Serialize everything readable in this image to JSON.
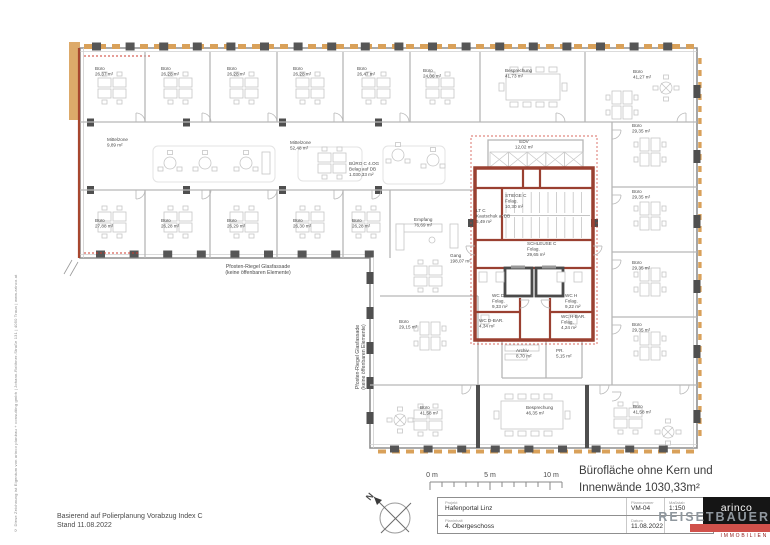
{
  "page": {
    "copyright_vertical": "© Diese Zeichnung ist Eigentum von arinco planbau + consulting gmbh | Johann-Roithner-Straße 131 | 4050 Traun | www.arinco.at",
    "revision_note_line1": "Basierend auf Polierplanung Vorabzug Index C",
    "revision_note_line2": "Stand 11.08.2022"
  },
  "area_note": {
    "line1": "Bürofläche ohne Kern und",
    "line2": "Innenwände 1030,33m²"
  },
  "titleblock": {
    "project_label": "Projekt",
    "project": "Hafenportal Linz",
    "content_label": "Planinhalt",
    "content": "4. Obergeschoss",
    "number_label": "Plannummer",
    "number": "VM-04",
    "scale_label": "Maßstab",
    "scale": "1:150",
    "date_label": "Datum",
    "date": "11.08.2022"
  },
  "logo": {
    "brand": "arinco",
    "name": "REISETBAUER",
    "tagline": "IMMOBILIEN"
  },
  "colors": {
    "facade_orange": "#d9a15a",
    "core_red": "#9a4031",
    "fire_line_red": "#cc3b2f",
    "wall_grey": "#8f8f8f",
    "logo_red": "#d0514b",
    "logo_black": "#151515"
  },
  "plan": {
    "labels": [
      {
        "lines": [
          "Büro",
          "26,37 m²"
        ],
        "x": 95,
        "y": 70
      },
      {
        "lines": [
          "Büro",
          "26,28 m²"
        ],
        "x": 161,
        "y": 70
      },
      {
        "lines": [
          "Büro",
          "26,28 m²"
        ],
        "x": 227,
        "y": 70
      },
      {
        "lines": [
          "Büro",
          "26,28 m²"
        ],
        "x": 293,
        "y": 70
      },
      {
        "lines": [
          "Büro",
          "26,47 m²"
        ],
        "x": 357,
        "y": 70
      },
      {
        "lines": [
          "Büro",
          "24,06 m²"
        ],
        "x": 423,
        "y": 72
      },
      {
        "lines": [
          "Besprechung",
          "41,73 m²"
        ],
        "x": 505,
        "y": 72
      },
      {
        "lines": [
          "Büro",
          "41,27 m²"
        ],
        "x": 633,
        "y": 73
      },
      {
        "lines": [
          "Mittelzone",
          "9,89 m²"
        ],
        "x": 107,
        "y": 141
      },
      {
        "lines": [
          "Mittelzone",
          "52,48 m²"
        ],
        "x": 290,
        "y": 144
      },
      {
        "lines": [
          "BÜRO C 4.OG",
          "Belag auf DB",
          "1.030,33 m²"
        ],
        "x": 349,
        "y": 165
      },
      {
        "lines": [
          "EDV",
          "12,02 m²"
        ],
        "x": 524,
        "y": 143,
        "align": "middle"
      },
      {
        "lines": [
          "Empfang",
          "76,69 m²"
        ],
        "x": 414,
        "y": 221
      },
      {
        "lines": [
          "Büro",
          "27,88 m²"
        ],
        "x": 95,
        "y": 222
      },
      {
        "lines": [
          "Büro",
          "26,28 m²"
        ],
        "x": 161,
        "y": 222
      },
      {
        "lines": [
          "Büro",
          "26,29 m²"
        ],
        "x": 227,
        "y": 222
      },
      {
        "lines": [
          "Büro",
          "26,30 m²"
        ],
        "x": 293,
        "y": 222
      },
      {
        "lines": [
          "Büro",
          "26,28 m²"
        ],
        "x": 352,
        "y": 222
      },
      {
        "lines": [
          "Gang",
          "198,07 m²"
        ],
        "x": 450,
        "y": 257
      },
      {
        "lines": [
          "STIEGE C",
          "Folag.",
          "10,30 m²"
        ],
        "x": 505,
        "y": 197
      },
      {
        "lines": [
          "LT C",
          "Kautschuk a. DB",
          "5,49 m²"
        ],
        "x": 476,
        "y": 212
      },
      {
        "lines": [
          "SCHLEUSE C",
          "Folag.",
          "29,65 m²"
        ],
        "x": 527,
        "y": 245
      },
      {
        "lines": [
          "WC D",
          "Folag.",
          "9,33 m²"
        ],
        "x": 492,
        "y": 297
      },
      {
        "lines": [
          "WC H",
          "Folag.",
          "9,22 m²"
        ],
        "x": 565,
        "y": 297
      },
      {
        "lines": [
          "WC D-BAR.",
          "4,34 m²"
        ],
        "x": 479,
        "y": 322
      },
      {
        "lines": [
          "WC H-BAR.",
          "Folag.",
          "4,24 m²"
        ],
        "x": 561,
        "y": 318
      },
      {
        "lines": [
          "Archiv",
          "8,70 m²"
        ],
        "x": 516,
        "y": 352
      },
      {
        "lines": [
          "PR.",
          "5,15 m²"
        ],
        "x": 556,
        "y": 352
      },
      {
        "lines": [
          "Büro",
          "29,35 m²"
        ],
        "x": 632,
        "y": 127
      },
      {
        "lines": [
          "Büro",
          "29,35 m²"
        ],
        "x": 632,
        "y": 193
      },
      {
        "lines": [
          "Büro",
          "29,35 m²"
        ],
        "x": 632,
        "y": 264
      },
      {
        "lines": [
          "Büro",
          "29,35 m²"
        ],
        "x": 632,
        "y": 326
      },
      {
        "lines": [
          "Büro",
          "41,58 m²"
        ],
        "x": 633,
        "y": 408
      },
      {
        "lines": [
          "Büro",
          "41,58 m²"
        ],
        "x": 420,
        "y": 409
      },
      {
        "lines": [
          "Besprechung",
          "46,35 m²"
        ],
        "x": 526,
        "y": 409
      },
      {
        "lines": [
          "Büro",
          "29,15 m²"
        ],
        "x": 399,
        "y": 323
      },
      {
        "lines": [
          "Pfosten-Riegel Glasfassade",
          "(keine öffenbaren Elemente)"
        ],
        "x": 258,
        "y": 268,
        "align": "middle",
        "size": 5.2,
        "name": "facade-label-bottom"
      },
      {
        "lines": [
          "Pfosten-Riegel Glasfassade",
          "(keine öffenbaren Elemente)"
        ],
        "x": 359,
        "y": 357,
        "align": "middle",
        "rotate": -90,
        "size": 5.2,
        "name": "facade-label-left"
      },
      {
        "lines": [
          "0 m"
        ],
        "x": 432,
        "y": 477,
        "size": 7,
        "align": "middle",
        "name": "scale-tick-0"
      },
      {
        "lines": [
          "5 m"
        ],
        "x": 490,
        "y": 477,
        "size": 7,
        "align": "middle",
        "name": "scale-tick-5"
      },
      {
        "lines": [
          "10 m"
        ],
        "x": 551,
        "y": 477,
        "size": 7,
        "align": "middle",
        "name": "scale-tick-10"
      },
      {
        "lines": [
          "N"
        ],
        "x": 370,
        "y": 501,
        "size": 9,
        "rotate": -50,
        "bold": true,
        "name": "north-label"
      }
    ]
  }
}
